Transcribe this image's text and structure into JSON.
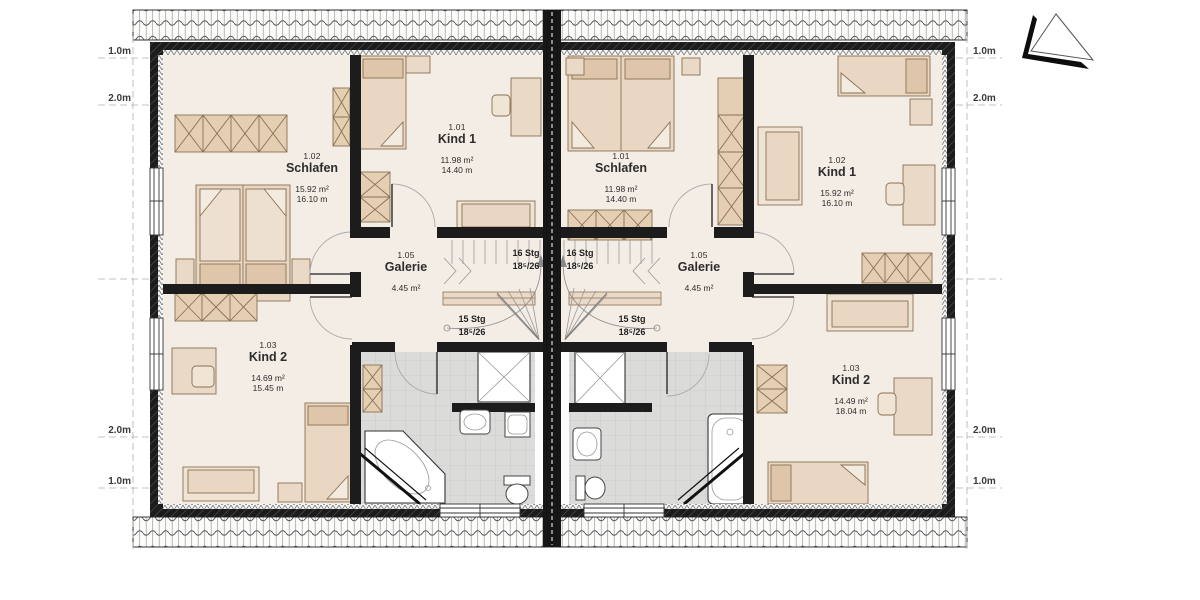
{
  "plan_type": "floor-plan",
  "dimensions": {
    "left": [
      "1.0m",
      "2.0m",
      "2.0m",
      "1.0m"
    ],
    "right": [
      "1.0m",
      "2.0m",
      "2.0m",
      "1.0m"
    ]
  },
  "left_unit": {
    "schlafen": {
      "number": "1.02",
      "name": "Schlafen",
      "area": "15.92 m²",
      "perimeter": "16.10 m"
    },
    "kind1": {
      "number": "1.01",
      "name": "Kind 1",
      "area": "11.98 m²",
      "perimeter": "14.40 m"
    },
    "kind2": {
      "number": "1.03",
      "name": "Kind 2",
      "area": "14.69 m²",
      "perimeter": "15.45 m"
    },
    "galerie": {
      "number": "1.05",
      "name": "Galerie",
      "area": "4.45 m²"
    },
    "stair_upper": {
      "label": "16 Stg",
      "ratio": "18⁵/26"
    },
    "stair_lower": {
      "label": "15 Stg",
      "ratio": "18⁵/26"
    }
  },
  "right_unit": {
    "schlafen": {
      "number": "1.01",
      "name": "Schlafen",
      "area": "11.98 m²",
      "perimeter": "14.40 m"
    },
    "kind1": {
      "number": "1.02",
      "name": "Kind 1",
      "area": "15.92 m²",
      "perimeter": "16.10 m"
    },
    "kind2": {
      "number": "1.03",
      "name": "Kind 2",
      "area": "14.49 m²",
      "perimeter": "18.04 m"
    },
    "galerie": {
      "number": "1.05",
      "name": "Galerie",
      "area": "4.45 m²"
    },
    "stair_upper": {
      "label": "16 Stg",
      "ratio": "18⁵/26"
    },
    "stair_lower": {
      "label": "15 Stg",
      "ratio": "18⁵/26"
    }
  },
  "icons": {
    "north_arrow": "north-arrow-triangle"
  },
  "colors": {
    "wall": "#1c1c1c",
    "floor": "#f4ede6",
    "bath_floor": "#dbdbd9",
    "furniture": "#ead9c6",
    "furniture_line": "#8a7054"
  }
}
